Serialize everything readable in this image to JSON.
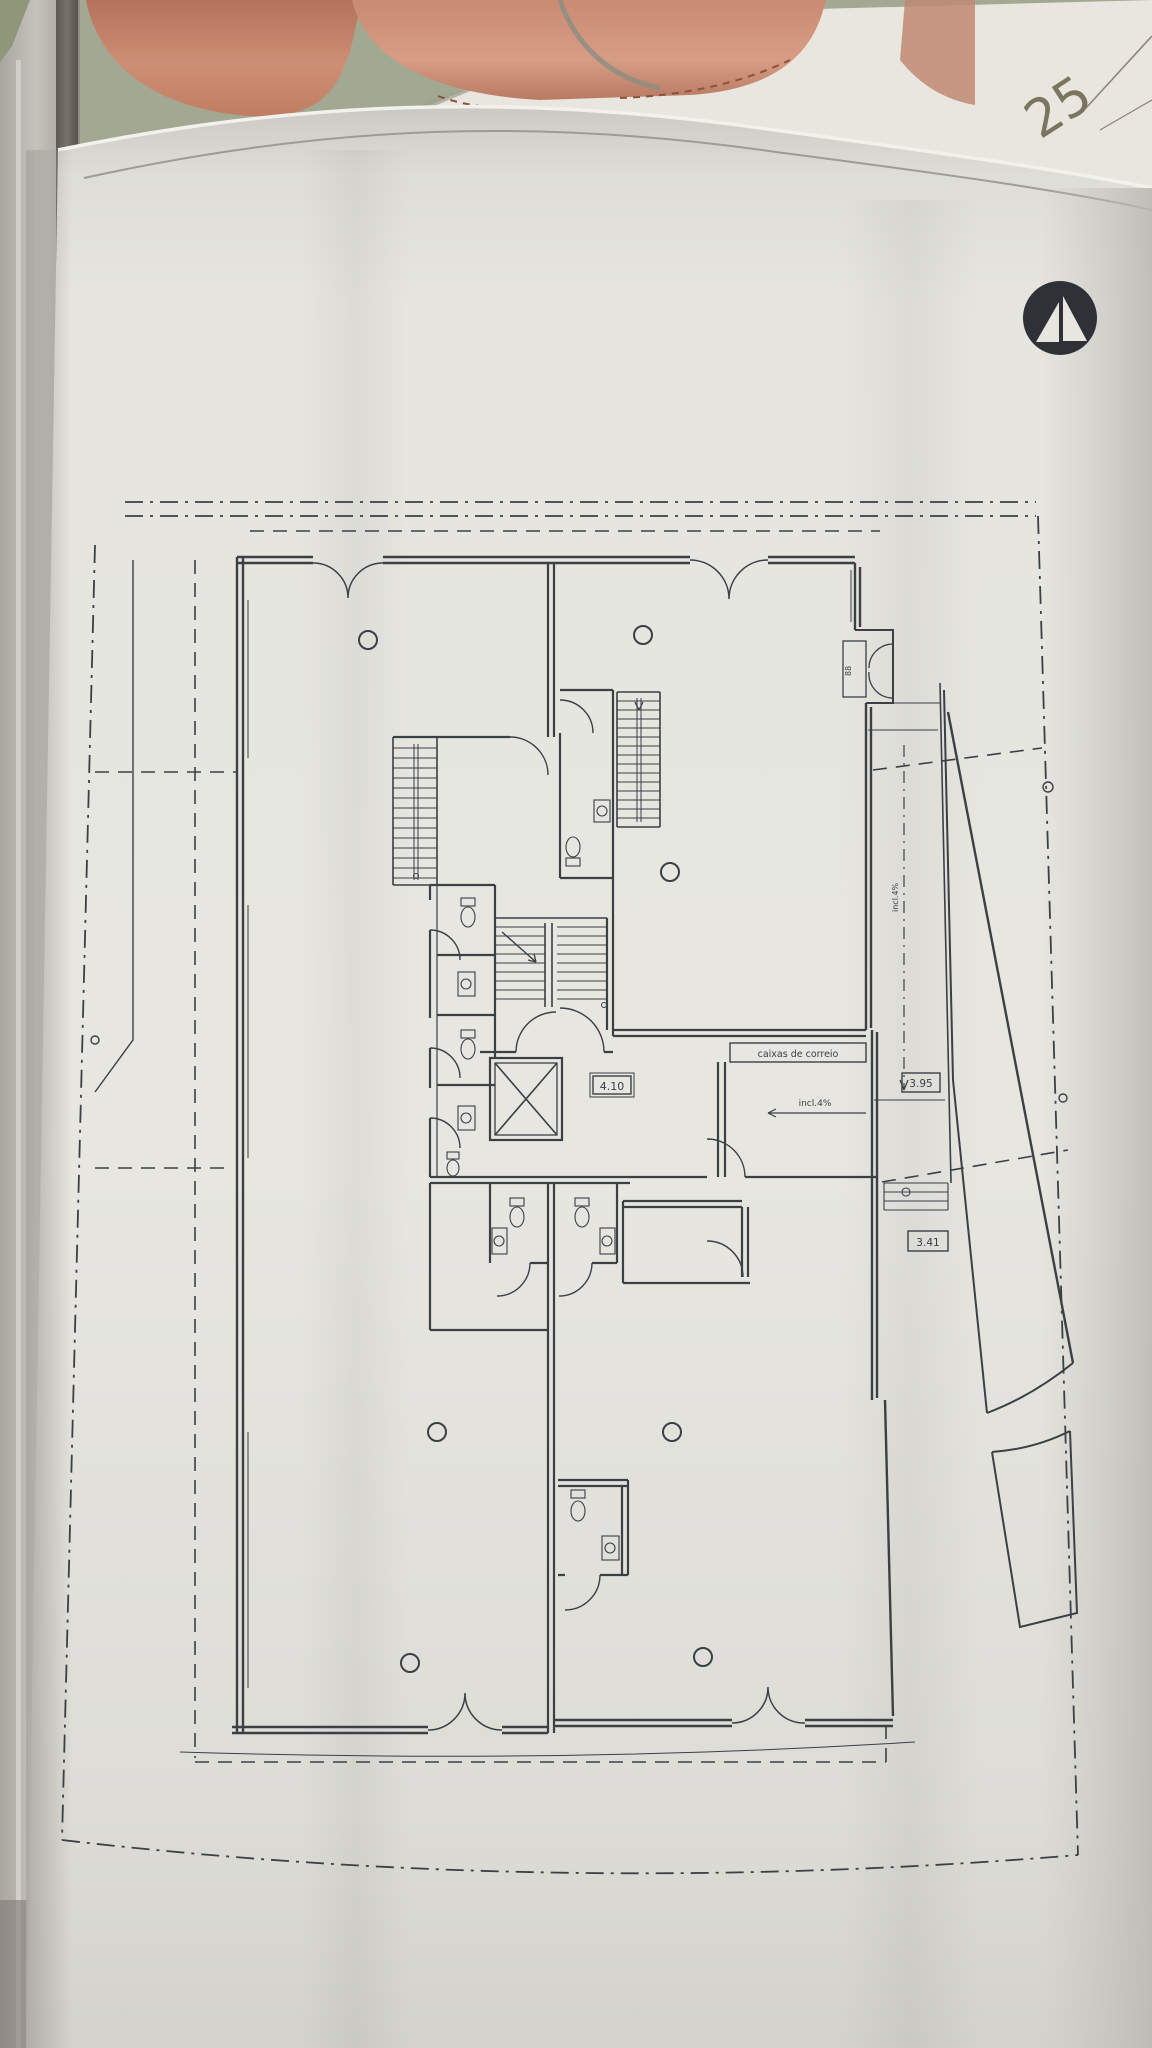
{
  "photo": {
    "description": "photograph of a rolled architectural floor-plan sheet",
    "sheet_number": "25",
    "colors": {
      "backdrop_green": "#a3a892",
      "window_frame_light": "#bfbbb5",
      "window_frame_dark": "#6e6962",
      "terracotta": "#c5826a",
      "terracotta_dark": "#9c5a44",
      "back_sheet": "#e8e6df",
      "main_sheet": "#e5e4df",
      "pencil": "#7b7460"
    }
  },
  "plan": {
    "labels": {
      "mailboxes": "caixas de correio",
      "hall_slope": "incl.4%",
      "corridor_slope": "incl.4%",
      "cabinet_code": "88"
    },
    "dimensions": {
      "hall": "4.10",
      "entry": "3.95",
      "steps": "3.41"
    },
    "colors": {
      "ink": "#3a4044",
      "logo": "#2e3237"
    }
  }
}
